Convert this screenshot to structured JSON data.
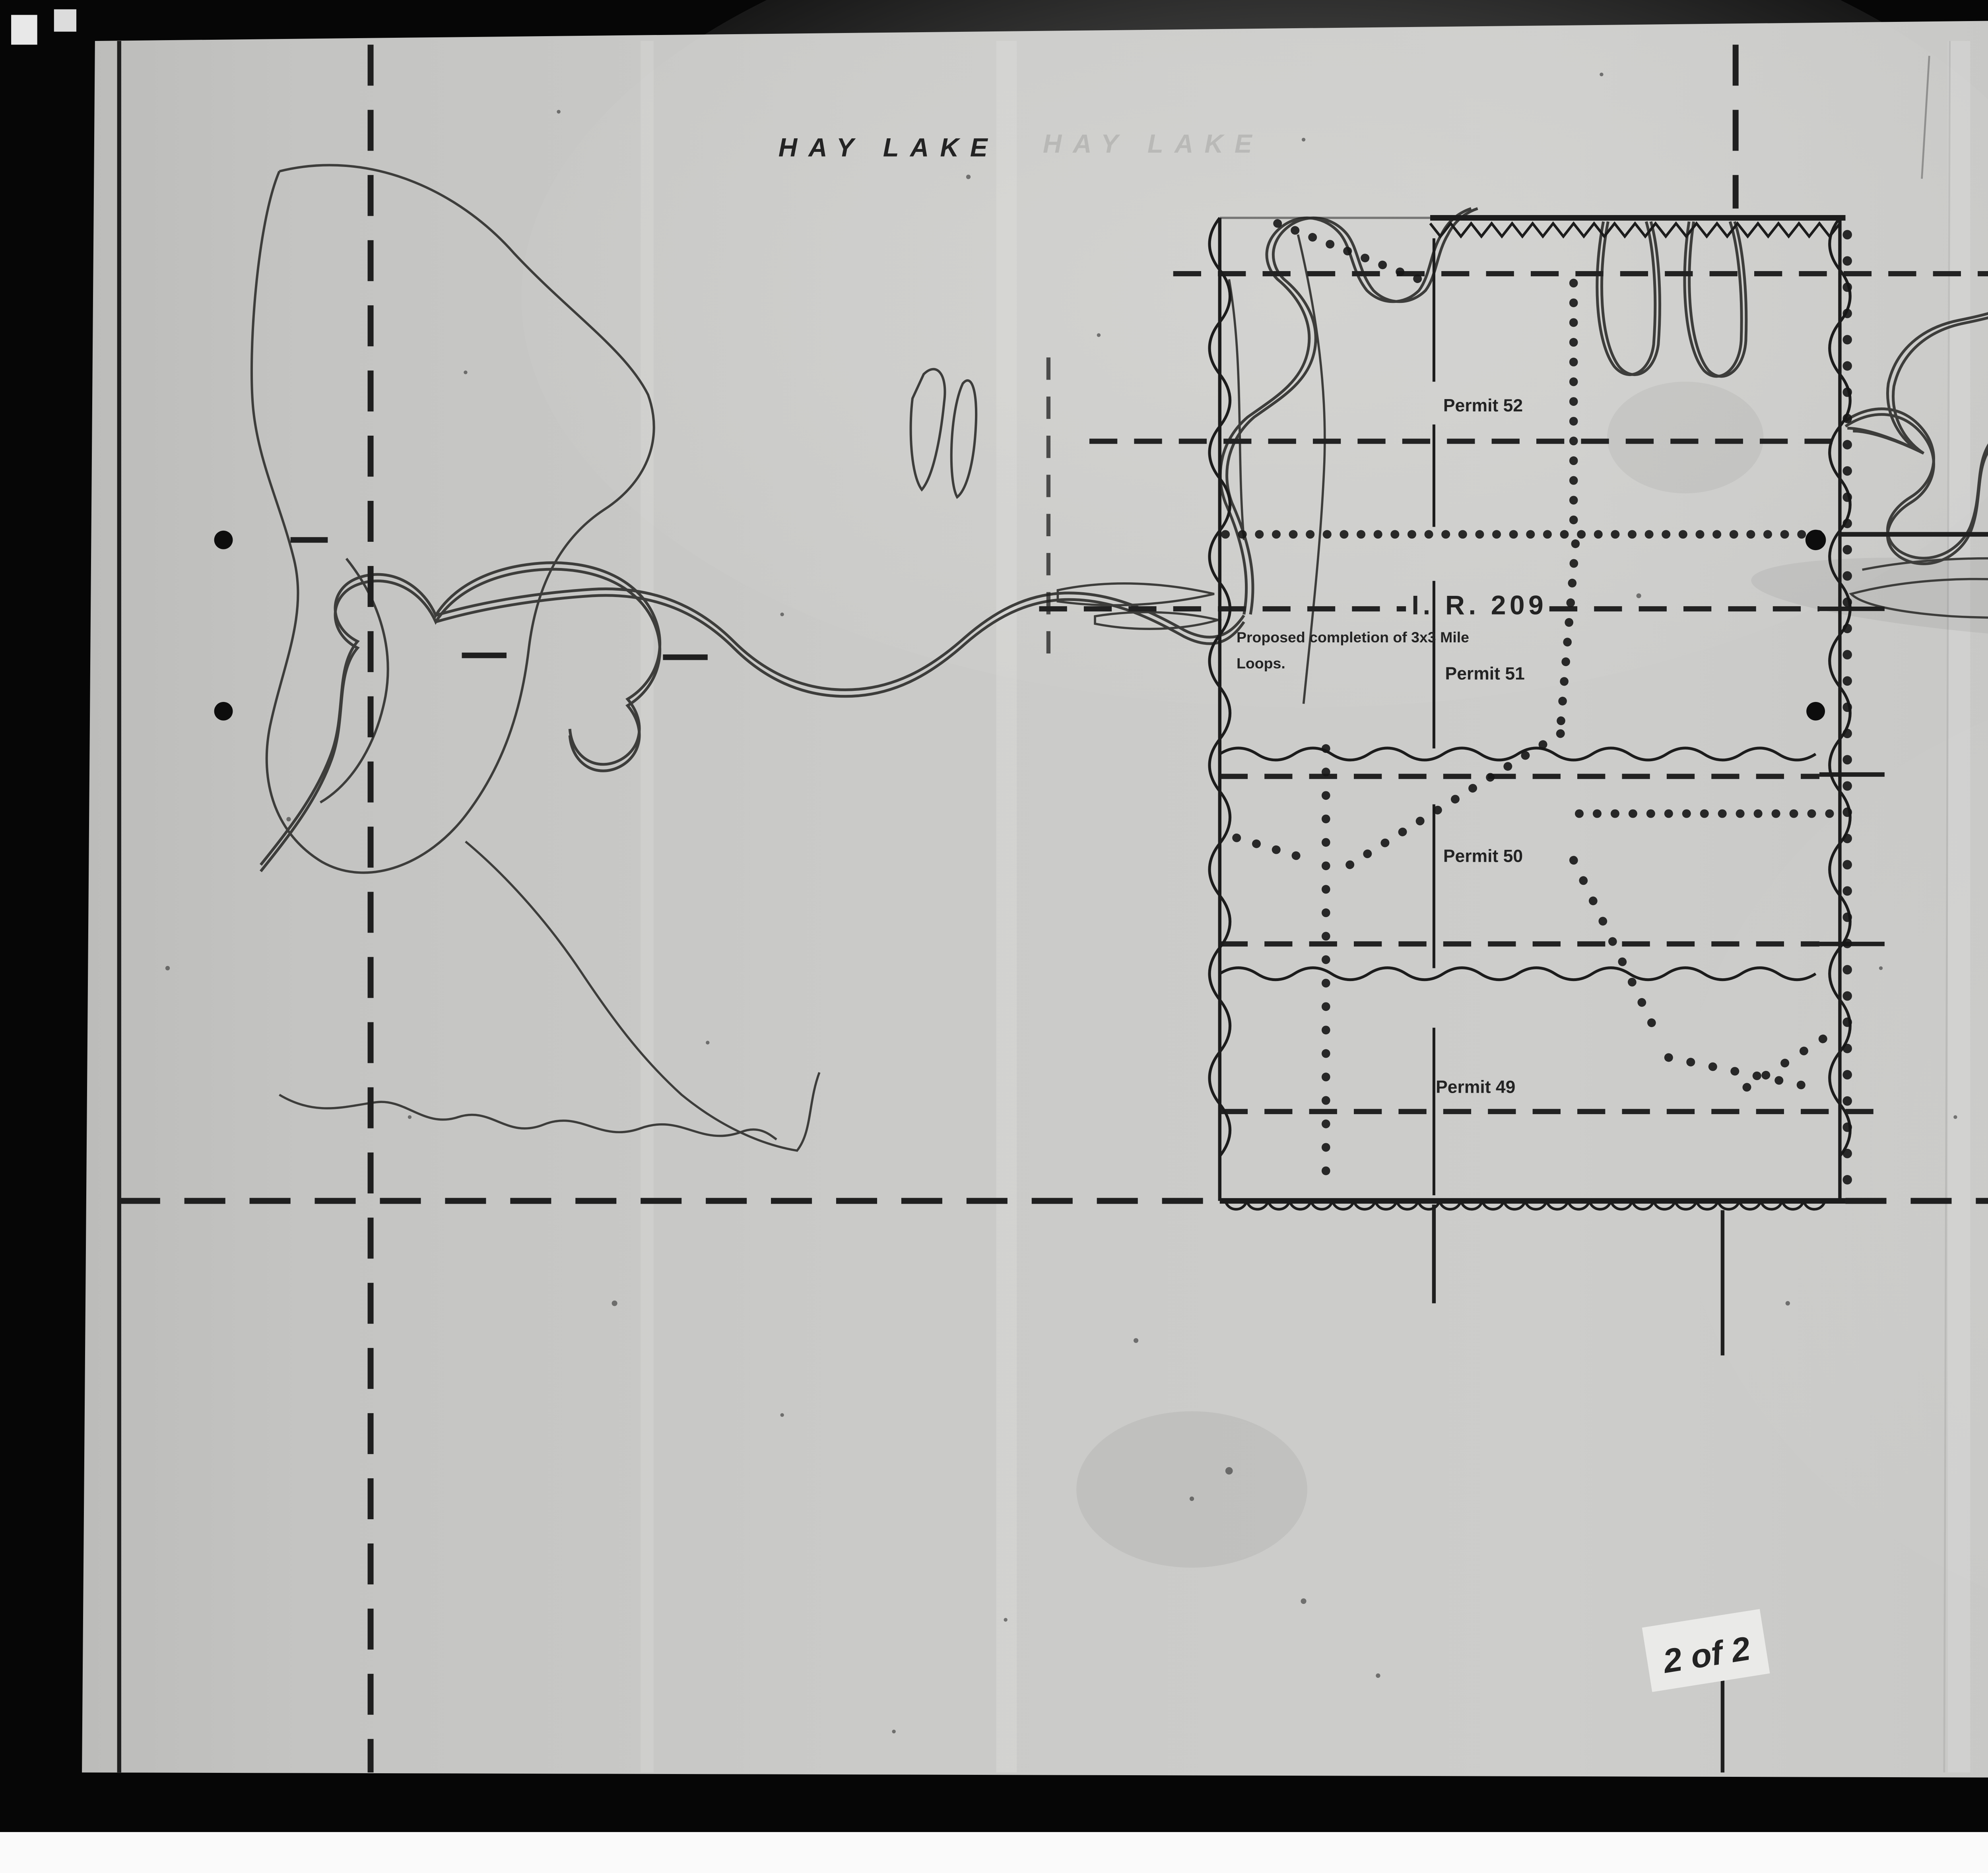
{
  "map": {
    "place_label": "HAY LAKE",
    "township_labels": [
      "T.113",
      "T.112"
    ],
    "base_line_label": "29TH. BASE LINE",
    "reserve_label": "I. R. 209",
    "note_line1": "Proposed completion of 3x3 Mile",
    "note_line2": "Loops.",
    "permits": [
      "Permit 52",
      "Permit 51",
      "Permit 50",
      "Permit 49"
    ]
  },
  "title_block": {
    "title": "HAY LAKE INDIAN RESERVE NO. 209",
    "legend": [
      {
        "symbol": "dotted-line-icon",
        "label": "SEISMIC COVERAGE"
      },
      {
        "symbol": "dashed-line-icon",
        "label": "AEROMAGNETIC FLIGHT LINES"
      }
    ],
    "org_line1": "IMPERIAL OIL LIMITED",
    "org_line2": "EXPLORATION DEPARTMENT",
    "date": "NOVEMBER 21, 1952",
    "location": "PEACE RIVER"
  },
  "annotations": {
    "sheet_note": "2 of 2",
    "pencil_mark": "18"
  },
  "colors": {
    "paper": "#c8c8c6",
    "ink": "#1c1c1c",
    "scan_bg": "#060606"
  }
}
